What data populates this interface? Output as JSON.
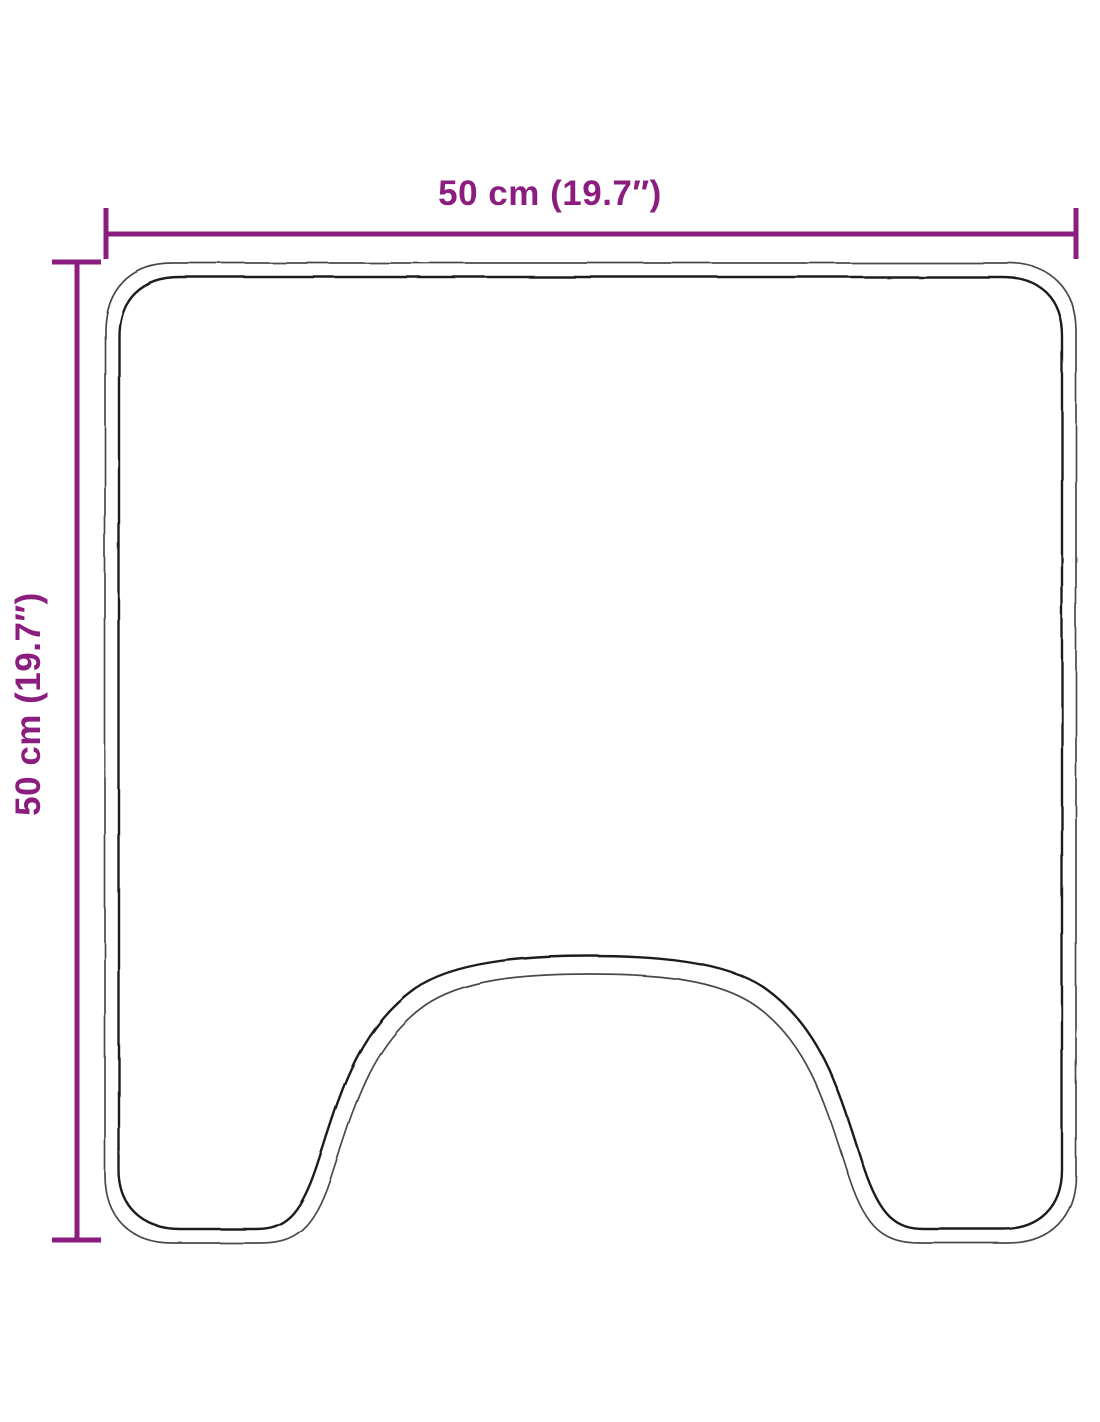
{
  "diagram": {
    "title": "bath-mat-dimension-diagram",
    "width_label": "50 cm (19.7″)",
    "height_label": "50 cm (19.7″)"
  },
  "colors": {
    "dimension": "#8b1d7f",
    "outline_outer": "#4a4a4a",
    "outline_inner": "#1e1e1e",
    "background": "#ffffff"
  }
}
